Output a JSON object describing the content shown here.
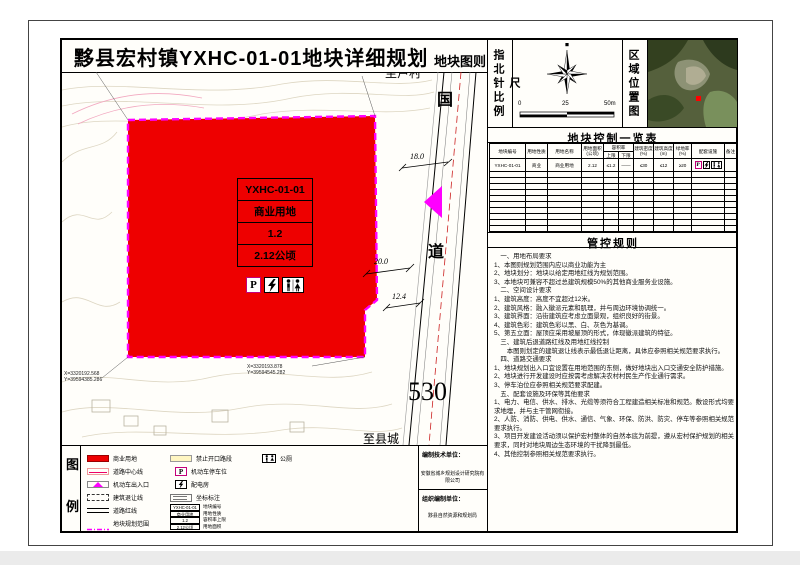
{
  "title": "黟县宏村镇YXHC-01-01地块详细规划",
  "sheet_label": "地块图则",
  "compass": {
    "panel_label": "指北针比例尺",
    "scale_0": "0",
    "scale_25": "25",
    "scale_50": "50m"
  },
  "location_map": {
    "panel_label": "区域位置图",
    "marker_color": "#ff0000"
  },
  "map": {
    "road_name_top": "国",
    "road_name_bottom": "道",
    "road_number": "530",
    "dest_north": "至卢村",
    "dest_south": "至县城",
    "dim_road_width": "18.0",
    "dim_setback": "20.0",
    "dim_half": "12.4",
    "coord_top_left_x": "X=3320325.160",
    "coord_top_left_y": "Y=39594389.756",
    "coord_top_right_x": "X=3320326.470",
    "coord_top_right_y": "Y=39594848.731",
    "coord_bottom_left_x": "X=3320192.568",
    "coord_bottom_left_y": "Y=39594385.286",
    "coord_bottom_mid_x": "X=3320193.878",
    "coord_bottom_mid_y": "Y=39594545.282",
    "parcel": {
      "code": "YXHC-01-01",
      "use": "商业用地",
      "far": "1.2",
      "area": "2.12公顷"
    },
    "colors": {
      "parcel_fill": "#ee0000",
      "boundary": "#ff00ff",
      "entrance": "#ff00ff",
      "road_centerline": "#cc2222",
      "contour": "#ddd6c2"
    }
  },
  "control_table": {
    "title": "地块控制一览表",
    "headers": {
      "code": "地块编号",
      "nature": "用地性质",
      "name": "用地名称",
      "area": "用地面积(公顷)",
      "far": "容积率",
      "far_max": "上限",
      "far_min": "下限",
      "density": "建筑密度(%)",
      "height": "建筑高度(m)",
      "green": "绿地率(%)",
      "facility": "配套设施",
      "note": "备注"
    },
    "row": {
      "code": "YXHC-01-01",
      "nature": "商业",
      "name": "商业用地",
      "area": "2.12",
      "far_max": "≤1.2",
      "far_min": "——",
      "density": "≤30",
      "height": "≤12",
      "green": "≥20",
      "note": ""
    }
  },
  "rules": {
    "title": "管控规则",
    "lines": [
      "　一、用地布局要求",
      "1、本图则规划范围内应以商业功能为主",
      "2、地块划分：地块以给定用地红线为规划范围。",
      "3、本地块可兼容不超过总建筑规模50%的其他商业服务业设施。",
      "　二、空间设计要求",
      "1、建筑高度：高度不宜超过12米。",
      "2、建筑风格：融入徽派元素和肌理，并与周边环境协调统一。",
      "3、建筑界面：沿街建筑应考虑立面景观，组织良好的街景。",
      "4、建筑色彩：建筑色彩以黑、白、灰色为基调。",
      "5、第五立面：屋顶应采用坡屋顶的形式，体现徽派建筑的特征。",
      "　三、建筑后退道路红线及用地红线控制",
      "　　本图则划定的建筑退让线表示最低退让距离，具体应参照相关规范要求执行。",
      "　四、道路交通要求",
      "1、地块规划出入口宜设置在用地范围的东侧，做好地块出入口交通安全防护措施。",
      "2、地块进行开发建设时应按需考虑解决农村村民生产作业通行需求。",
      "3、停车泊位应参照相关规范要求配建。",
      "　五、配套设施及环保等其他要求",
      "1、电力、电信、供水、排水、光缆等须符合工程建造相关标准和规范。敷设形式均要求地埋，并与主干管网衔接。",
      "2、人防、消防、供电、供水、通信、气象、环保、防洪、防灾、停车等参照相关规范要求执行。",
      "3、项目开发建设活动须以保护宏村整体的自然本底为前提，遵从宏村保护规划的相关要求，同时对地块周边生态环境的干扰降到最低。",
      "4、其他控制参照相关规范要求执行。"
    ]
  },
  "legend": {
    "panel_label_top": "图",
    "panel_label_bottom": "例",
    "items": {
      "commercial": "商业用地",
      "road_center": "道路中心线",
      "vehicle_entrance": "机动车出入口",
      "setback": "建筑退让线",
      "road_redline": "道路红线",
      "plan_boundary": "地块规划范围",
      "no_opening": "禁止开口路段",
      "parking": "机动车停车位",
      "power_room": "配电房",
      "coordinate": "坐标标注",
      "toilet": "公厕"
    },
    "minitable": [
      {
        "value": "YXHC-01-01",
        "label": "地块编号"
      },
      {
        "value": "商业用地",
        "label": "用地性质"
      },
      {
        "value": "1.2",
        "label": "容积率上限"
      },
      {
        "value": "2.12公顷",
        "label": "用地面积"
      }
    ]
  },
  "credits": {
    "tech_label": "编制技术单位：",
    "tech_value": "安徽省城乡规划设计研究院有限公司",
    "org_label": "组织编制单位：",
    "org_value": "黟县自然资源和规划局"
  }
}
